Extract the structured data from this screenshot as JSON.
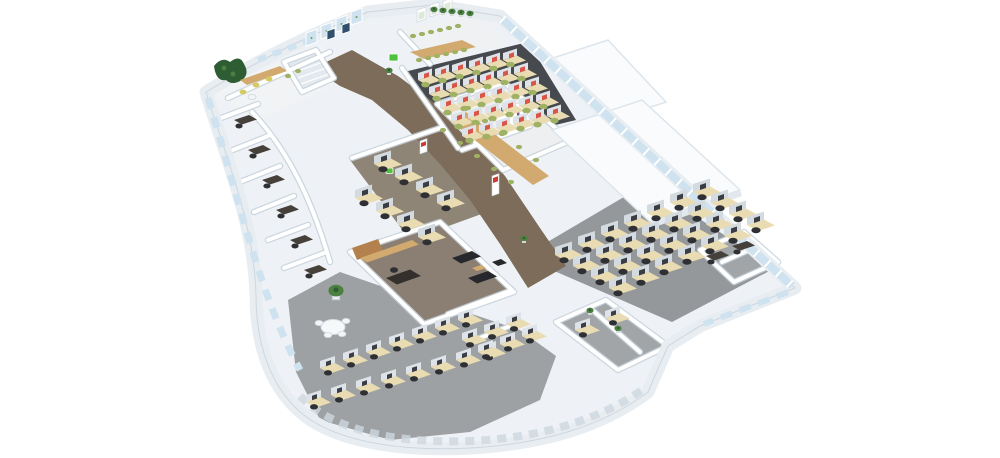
{
  "scene": {
    "type": "3d-isometric-office-floorplan-render",
    "background": "#ffffff",
    "total_workstations": 98
  },
  "palette": {
    "slab": "#eef2f6",
    "slab-edge": "#c2cdd6",
    "band": "#e8edf2",
    "glass": "#cfe2ef",
    "floor-dark": "#46494e",
    "floor-gray": "#95989b",
    "floor-gray2": "#9ea1a4",
    "carpet-brown": "#7d6c59",
    "wood-light": "#e9dcb2",
    "wood-mid": "#d2a96e",
    "wood-dark": "#b3814d",
    "chair-green": "#9fb163",
    "chair-black": "#2e3033",
    "chair-yellow": "#d6c95e",
    "screen-red": "#d95548",
    "plant": "#4c8040",
    "plant-dark": "#2f5d33",
    "sofa": "#26282b",
    "sign-red": "#cf3b32",
    "sign-green": "#4fc13c"
  },
  "zones": [
    {
      "id": "reception-lounge",
      "label": "Reception lounge",
      "guest_chairs": 5,
      "features": [
        "plant wall",
        "wood counter"
      ]
    },
    {
      "id": "entrance-lobby",
      "label": "Entrance lobby",
      "door_panels": 4,
      "wall_pictures": 2,
      "stairs": 1
    },
    {
      "id": "training-room",
      "label": "Training room",
      "table_seats": 12,
      "wall_posters": 3
    },
    {
      "id": "call-center",
      "label": "Call center open area",
      "workstations": 30,
      "chair_color": "green",
      "screen_color": "red"
    },
    {
      "id": "meeting-room",
      "label": "Meeting room",
      "table_seats": 10,
      "chair_color": "green"
    },
    {
      "id": "team-area",
      "label": "Central team cubicles",
      "workstations": 8
    },
    {
      "id": "private-offices-west",
      "label": "Private offices (west arc)",
      "offices": 6
    },
    {
      "id": "executive-office",
      "label": "Executive office",
      "desks": 1,
      "sofas": 2,
      "armchairs": 1,
      "features": [
        "wood cabinets",
        "coffee table"
      ]
    },
    {
      "id": "open-office-east",
      "label": "Open-plan office (east wing)",
      "workstations": 28,
      "chair_color": "black"
    },
    {
      "id": "breakout-area",
      "label": "Breakout area",
      "round_tables": 1,
      "chairs": 4,
      "features": [
        "palm plant"
      ]
    },
    {
      "id": "south-workstation-rows",
      "label": "South curved workstation rows",
      "workstations": 15
    },
    {
      "id": "south-center-offices",
      "label": "South partitioned desks",
      "workstations": 6
    },
    {
      "id": "ne-corner-rooms",
      "label": "North-east corner rooms",
      "desks": 2
    },
    {
      "id": "se-corner-rooms",
      "label": "South-east corner rooms",
      "desks": 2,
      "plants": 2
    },
    {
      "id": "service-cores",
      "label": "Enclosed service cores",
      "count": 2
    }
  ],
  "signage": {
    "red_wall_signs": 2,
    "green_exit_signs": 2,
    "bookshelf_units": 1
  }
}
